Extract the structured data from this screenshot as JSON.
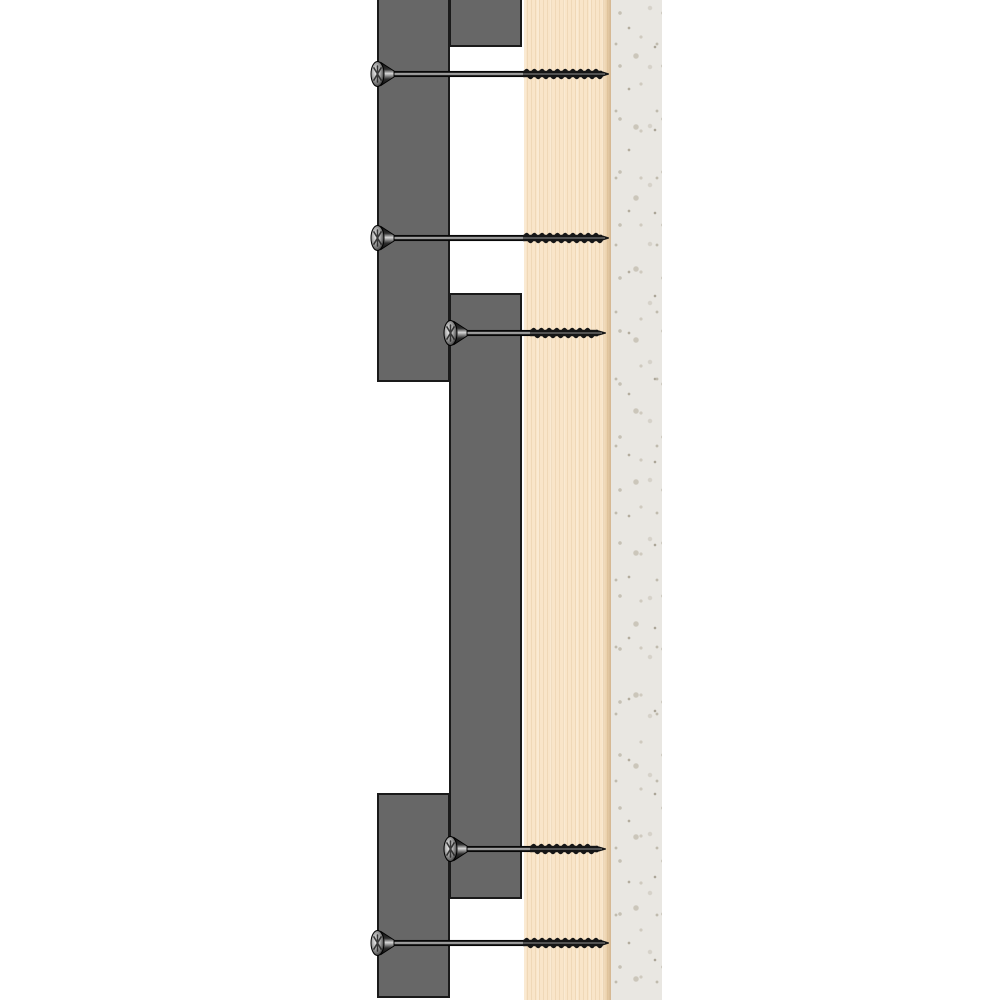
{
  "scene": {
    "width": 1000,
    "height": 1000,
    "background": "#ffffff",
    "kind": "construction-cross-section-diagram"
  },
  "colors": {
    "batten_fill": "#676767",
    "batten_border": "#1a1a1a",
    "board_fill": "#f9e5c9",
    "board_grain": "#cdaa78",
    "board_edge_shadow": "#a57d4b",
    "wall_fill": "#e9e7e2",
    "wall_speckle": "#c6c1b5",
    "screw_dark": "#141414",
    "screw_mid": "#4a4a4a",
    "screw_highlight": "#d8d8d8"
  },
  "layers": {
    "wall": {
      "x": 611,
      "y": 0,
      "width": 51,
      "height": 1000
    },
    "board": {
      "x": 524,
      "y": 0,
      "width": 87,
      "height": 1000,
      "edge_band_width": 9
    },
    "battens": [
      {
        "x": 377,
        "y": 0,
        "width": 73,
        "height": 382,
        "top_border": false
      },
      {
        "x": 449,
        "y": 0,
        "width": 73,
        "height": 47,
        "top_border": false
      },
      {
        "x": 449,
        "y": 293,
        "width": 73,
        "height": 606,
        "top_border": true
      },
      {
        "x": 377,
        "y": 793,
        "width": 73,
        "height": 205,
        "top_border": true
      }
    ]
  },
  "screws": [
    {
      "y": 74,
      "head_x": 371,
      "thread_start": 523,
      "thread_end": 600,
      "tip_x": 609
    },
    {
      "y": 238,
      "head_x": 371,
      "thread_start": 523,
      "thread_end": 600,
      "tip_x": 609
    },
    {
      "y": 333,
      "head_x": 444,
      "thread_start": 530,
      "thread_end": 596,
      "tip_x": 606
    },
    {
      "y": 849,
      "head_x": 444,
      "thread_start": 530,
      "thread_end": 596,
      "tip_x": 606
    },
    {
      "y": 943,
      "head_x": 371,
      "thread_start": 523,
      "thread_end": 600,
      "tip_x": 609
    }
  ],
  "screw_style": {
    "shaft_half": 2.7,
    "thread_half": 3.2,
    "thread_outer": 8.5,
    "thread_pitch": 7.7,
    "head_rx": 6.5,
    "head_ry": 12.5,
    "cone_len": 13
  }
}
